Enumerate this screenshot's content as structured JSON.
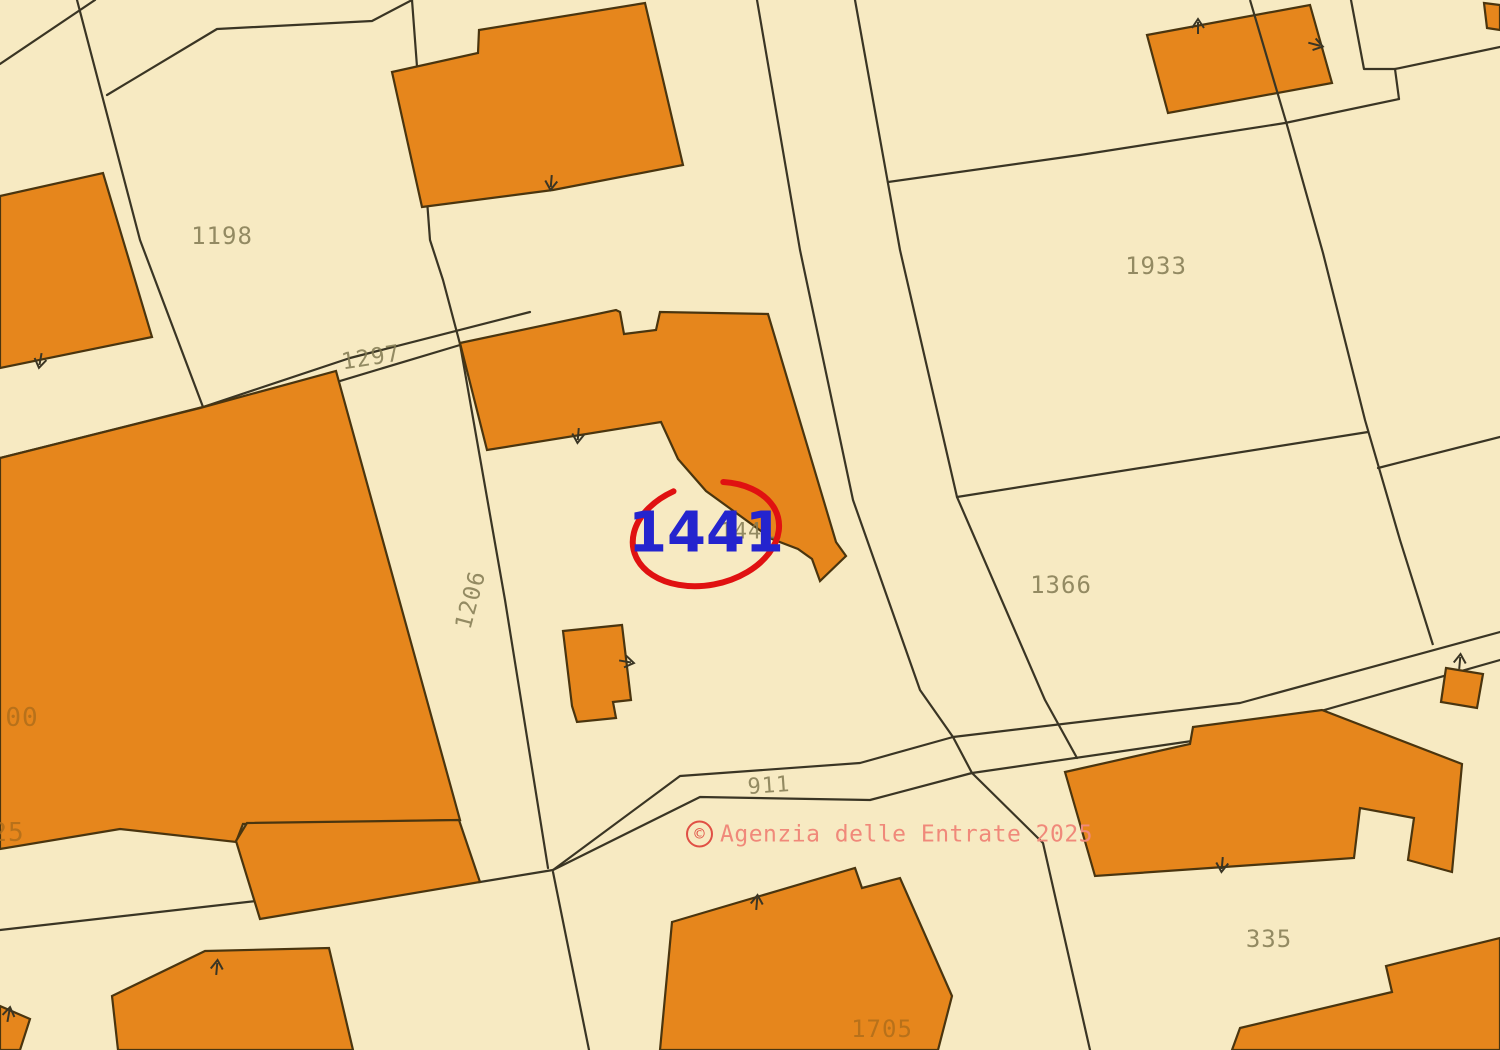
{
  "title": "Cadastral map extract",
  "watermark": {
    "symbol": "©",
    "text": "Agenzia delle Entrate 2025",
    "text_color": "#F0897A",
    "ring_color": "#E05045",
    "x": 686,
    "y": 834
  },
  "highlight": {
    "text": "1441",
    "text_color": "#2424CE",
    "font_size": 56,
    "circle_color": "#E01111",
    "cx": 706,
    "cy": 534,
    "rx": 74,
    "ry": 51,
    "rotation": -12,
    "gap_start_deg": 252,
    "gap_end_deg": 292,
    "stroke_width": 6
  },
  "map": {
    "width": 1500,
    "height": 1050,
    "background": "#F7EAC2",
    "line_color": "#3A3524",
    "building_fill": "#E6861C",
    "building_stroke": "#4A350F",
    "label_color": "#827A52",
    "label_color_on_building": "#B06E1A",
    "labels": [
      {
        "text": "1198",
        "x": 222,
        "y": 236,
        "rot": 0,
        "size": 24,
        "on_building": false
      },
      {
        "text": "1297",
        "x": 371,
        "y": 358,
        "rot": -9,
        "size": 23,
        "on_building": false
      },
      {
        "text": "1206",
        "x": 471,
        "y": 600,
        "rot": -75,
        "size": 23,
        "on_building": false
      },
      {
        "text": "1933",
        "x": 1156,
        "y": 266,
        "rot": 0,
        "size": 24,
        "on_building": false
      },
      {
        "text": "1366",
        "x": 1061,
        "y": 585,
        "rot": 0,
        "size": 24,
        "on_building": false
      },
      {
        "text": "911",
        "x": 769,
        "y": 786,
        "rot": -4,
        "size": 22,
        "on_building": false
      },
      {
        "text": "335",
        "x": 1269,
        "y": 939,
        "rot": 0,
        "size": 24,
        "on_building": false
      },
      {
        "text": "1705",
        "x": 882,
        "y": 1029,
        "rot": 0,
        "size": 24,
        "on_building": true
      },
      {
        "text": "00",
        "x": 22,
        "y": 718,
        "rot": 0,
        "size": 26,
        "on_building": true
      },
      {
        "text": "25",
        "x": 8,
        "y": 833,
        "rot": 0,
        "size": 26,
        "on_building": true
      },
      {
        "text": "1441",
        "x": 748,
        "y": 532,
        "rot": 0,
        "size": 22,
        "on_building": false
      }
    ],
    "lines": [
      {
        "name": "corner-cut-nw",
        "points": [
          [
            95,
            0
          ],
          [
            0,
            64
          ]
        ]
      },
      {
        "name": "boundary-west-1198",
        "points": [
          [
            77,
            0
          ],
          [
            140,
            240
          ],
          [
            203,
            407
          ]
        ]
      },
      {
        "name": "boundary-west-spur",
        "points": [
          [
            203,
            407
          ],
          [
            0,
            458
          ]
        ]
      },
      {
        "name": "boundary-nw-branch",
        "points": [
          [
            107,
            95
          ],
          [
            217,
            29
          ],
          [
            372,
            21
          ],
          [
            412,
            0
          ]
        ]
      },
      {
        "name": "boundary-1297-a",
        "points": [
          [
            203,
            407
          ],
          [
            350,
            358
          ],
          [
            530,
            312
          ]
        ]
      },
      {
        "name": "boundary-1297-b",
        "points": [
          [
            210,
            420
          ],
          [
            460,
            345
          ]
        ]
      },
      {
        "name": "boundary-v0",
        "points": [
          [
            412,
            0
          ],
          [
            430,
            240
          ],
          [
            443,
            280
          ],
          [
            460,
            344
          ]
        ]
      },
      {
        "name": "boundary-1206-east",
        "points": [
          [
            460,
            344
          ],
          [
            505,
            600
          ],
          [
            548,
            868
          ]
        ]
      },
      {
        "name": "boundary-v1-south",
        "points": [
          [
            553,
            872
          ],
          [
            589,
            1050
          ]
        ]
      },
      {
        "name": "road-911-north",
        "points": [
          [
            553,
            870
          ],
          [
            680,
            776
          ],
          [
            860,
            763
          ],
          [
            953,
            737
          ]
        ]
      },
      {
        "name": "road-911-north-east",
        "points": [
          [
            953,
            737
          ],
          [
            1240,
            703
          ],
          [
            1500,
            632
          ]
        ]
      },
      {
        "name": "road-911-south",
        "points": [
          [
            553,
            870
          ],
          [
            700,
            797
          ],
          [
            870,
            800
          ],
          [
            972,
            773
          ]
        ]
      },
      {
        "name": "road-911-south-east",
        "points": [
          [
            972,
            773
          ],
          [
            1240,
            734
          ],
          [
            1500,
            660
          ]
        ]
      },
      {
        "name": "road-junction-link",
        "points": [
          [
            953,
            737
          ],
          [
            972,
            773
          ]
        ]
      },
      {
        "name": "road-main-west",
        "points": [
          [
            757,
            0
          ],
          [
            800,
            250
          ],
          [
            853,
            500
          ],
          [
            920,
            690
          ],
          [
            953,
            737
          ]
        ]
      },
      {
        "name": "road-main-east",
        "points": [
          [
            855,
            0
          ],
          [
            900,
            250
          ],
          [
            957,
            497
          ],
          [
            1045,
            700
          ],
          [
            1077,
            758
          ]
        ]
      },
      {
        "name": "boundary-south-lane",
        "points": [
          [
            972,
            773
          ],
          [
            1043,
            843
          ],
          [
            1090,
            1050
          ]
        ]
      },
      {
        "name": "boundary-road-sw",
        "points": [
          [
            0,
            930
          ],
          [
            300,
            896
          ],
          [
            480,
            882
          ],
          [
            553,
            870
          ]
        ]
      },
      {
        "name": "boundary-1933-north",
        "points": [
          [
            888,
            182
          ],
          [
            1080,
            155
          ],
          [
            1285,
            123
          ],
          [
            1399,
            99
          ]
        ]
      },
      {
        "name": "boundary-ne-step",
        "points": [
          [
            1399,
            99
          ],
          [
            1395,
            69
          ],
          [
            1364,
            69
          ],
          [
            1351,
            0
          ]
        ]
      },
      {
        "name": "boundary-ne-branch",
        "points": [
          [
            1395,
            69
          ],
          [
            1500,
            47
          ]
        ]
      },
      {
        "name": "boundary-1366-north",
        "points": [
          [
            957,
            497
          ],
          [
            1368,
            432
          ]
        ]
      },
      {
        "name": "boundary-east-mid",
        "points": [
          [
            1378,
            468
          ],
          [
            1500,
            437
          ]
        ]
      },
      {
        "name": "boundary-1933-east",
        "points": [
          [
            1250,
            0
          ],
          [
            1287,
            125
          ],
          [
            1323,
            253
          ],
          [
            1365,
            420
          ],
          [
            1400,
            540
          ],
          [
            1433,
            645
          ]
        ],
        "above": true
      }
    ],
    "buildings": [
      {
        "name": "building-nw",
        "points": [
          [
            0,
            196
          ],
          [
            103,
            173
          ],
          [
            152,
            337
          ],
          [
            0,
            368
          ]
        ]
      },
      {
        "name": "building-large-west",
        "points": [
          [
            0,
            458
          ],
          [
            200,
            408
          ],
          [
            336,
            371
          ],
          [
            460,
            820
          ],
          [
            243,
            824
          ],
          [
            236,
            842
          ],
          [
            120,
            829
          ],
          [
            0,
            849
          ]
        ]
      },
      {
        "name": "building-west-lobe",
        "points": [
          [
            236,
            841
          ],
          [
            247,
            823
          ],
          [
            459,
            820
          ],
          [
            480,
            882
          ],
          [
            260,
            919
          ]
        ]
      },
      {
        "name": "building-top-center",
        "points": [
          [
            479,
            30
          ],
          [
            645,
            3
          ],
          [
            683,
            165
          ],
          [
            553,
            190
          ],
          [
            422,
            207
          ],
          [
            392,
            72
          ],
          [
            478,
            53
          ]
        ]
      },
      {
        "name": "building-l-central",
        "points": [
          [
            460,
            343
          ],
          [
            616,
            310
          ],
          [
            620,
            312
          ],
          [
            624,
            334
          ],
          [
            656,
            330
          ],
          [
            660,
            312
          ],
          [
            768,
            314
          ],
          [
            836,
            542
          ],
          [
            846,
            556
          ],
          [
            820,
            581
          ],
          [
            812,
            559
          ],
          [
            798,
            549
          ],
          [
            772,
            539
          ],
          [
            706,
            491
          ],
          [
            678,
            459
          ],
          [
            661,
            422
          ],
          [
            487,
            450
          ]
        ]
      },
      {
        "name": "building-courtyard-small",
        "points": [
          [
            563,
            631
          ],
          [
            622,
            625
          ],
          [
            631,
            700
          ],
          [
            613,
            702
          ],
          [
            616,
            718
          ],
          [
            577,
            722
          ],
          [
            572,
            706
          ]
        ]
      },
      {
        "name": "building-top-right",
        "points": [
          [
            1147,
            35
          ],
          [
            1310,
            5
          ],
          [
            1332,
            83
          ],
          [
            1168,
            113
          ]
        ]
      },
      {
        "name": "building-ne-corner",
        "points": [
          [
            1484,
            3
          ],
          [
            1500,
            5
          ],
          [
            1500,
            30
          ],
          [
            1487,
            28
          ]
        ]
      },
      {
        "name": "building-small-east",
        "points": [
          [
            1446,
            668
          ],
          [
            1483,
            674
          ],
          [
            1477,
            708
          ],
          [
            1441,
            702
          ]
        ]
      },
      {
        "name": "building-long-east",
        "points": [
          [
            1065,
            772
          ],
          [
            1190,
            744
          ],
          [
            1193,
            727
          ],
          [
            1322,
            710
          ],
          [
            1462,
            764
          ],
          [
            1452,
            872
          ],
          [
            1408,
            860
          ],
          [
            1414,
            818
          ],
          [
            1360,
            808
          ],
          [
            1354,
            858
          ],
          [
            1095,
            876
          ]
        ]
      },
      {
        "name": "building-sw",
        "points": [
          [
            205,
            951
          ],
          [
            329,
            948
          ],
          [
            353,
            1050
          ],
          [
            118,
            1050
          ],
          [
            112,
            996
          ]
        ]
      },
      {
        "name": "building-sw-corner",
        "points": [
          [
            0,
            1006
          ],
          [
            30,
            1019
          ],
          [
            20,
            1050
          ],
          [
            0,
            1050
          ]
        ]
      },
      {
        "name": "building-1705",
        "points": [
          [
            672,
            922
          ],
          [
            855,
            868
          ],
          [
            862,
            888
          ],
          [
            900,
            878
          ],
          [
            952,
            996
          ],
          [
            938,
            1050
          ],
          [
            660,
            1050
          ]
        ]
      },
      {
        "name": "building-se-corner",
        "points": [
          [
            1240,
            1028
          ],
          [
            1392,
            992
          ],
          [
            1386,
            966
          ],
          [
            1500,
            938
          ],
          [
            1500,
            1050
          ],
          [
            1232,
            1050
          ]
        ]
      }
    ],
    "ticks": [
      {
        "x": 551,
        "y": 184,
        "angle": 95
      },
      {
        "x": 40,
        "y": 362,
        "angle": 100
      },
      {
        "x": 578,
        "y": 437,
        "angle": 95
      },
      {
        "x": 628,
        "y": 662,
        "angle": 10
      },
      {
        "x": 217,
        "y": 966,
        "angle": -85
      },
      {
        "x": 9,
        "y": 1013,
        "angle": -80
      },
      {
        "x": 757,
        "y": 901,
        "angle": -85
      },
      {
        "x": 1222,
        "y": 866,
        "angle": 95
      },
      {
        "x": 1460,
        "y": 660,
        "angle": -85
      },
      {
        "x": 1198,
        "y": 25,
        "angle": -90
      },
      {
        "x": 1317,
        "y": 45,
        "angle": 15
      }
    ]
  }
}
